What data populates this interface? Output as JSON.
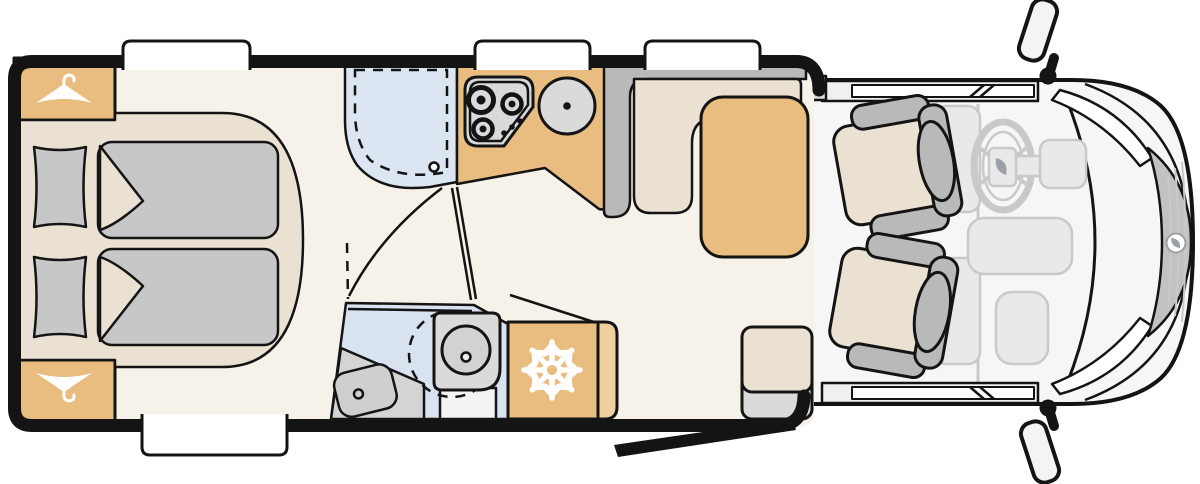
{
  "title": "Motorhome floor plan (top view)",
  "colors": {
    "wall": "#141414",
    "floor": "#f6f2e9",
    "wood": "#e9bc80",
    "wood_light": "#f0cf9f",
    "mattress": "#eae1d3",
    "fabric": "#c7c7c7",
    "fixture": "#dadada",
    "partition": "#b9b9b9",
    "shower_blue": "#dbe6f2",
    "bath_blue": "#d9e2ef",
    "bath_gray": "#d4d4d4",
    "cab_floor": "#f6f6f6",
    "ghost": "#e9e9e9",
    "ghost_line": "#c9c9c9",
    "grille": "#c2c2c2",
    "window_white": "#ffffff"
  },
  "areas": [
    "rear-bedroom",
    "wardrobe-top",
    "wardrobe-bottom",
    "shower",
    "kitchen",
    "bathroom",
    "refrigerator",
    "dinette",
    "entry",
    "cab"
  ],
  "icons": [
    "hanger-icon",
    "snowflake-icon",
    "burner-icon",
    "sink-icon",
    "drain-icon",
    "toilet-icon",
    "washbasin-icon",
    "steering-wheel-icon",
    "side-mirror-icon"
  ]
}
